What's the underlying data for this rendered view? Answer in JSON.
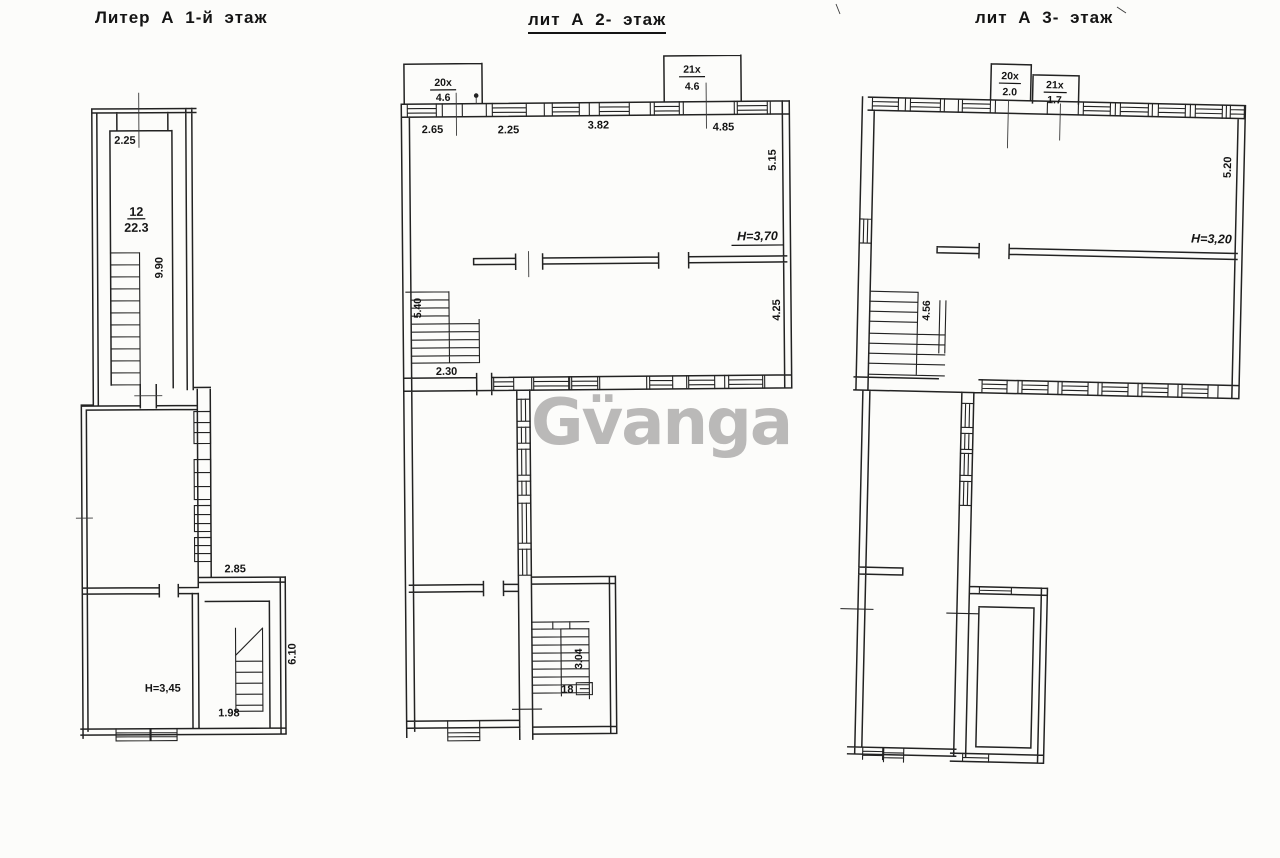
{
  "watermark": {
    "text": "Gv̈anga",
    "color": "#b2b0b0"
  },
  "plan1": {
    "title": "Литер А 1-й этаж",
    "dim_top": "2.25",
    "room_number": "12",
    "room_area": "22.3",
    "dim_vert": "9.90",
    "dim_annex_top": "2.85",
    "dim_annex_right": "6.10",
    "height_label": "H=3,45",
    "dim_stair": "1.98"
  },
  "plan2": {
    "title": "лит А 2- этаж",
    "balcony_left": {
      "num": "20x",
      "area": "4.6"
    },
    "balcony_right": {
      "num": "21x",
      "area": "4.6"
    },
    "dim_top_1": "2.65",
    "dim_top_2": "2.25",
    "dim_top_3": "3.82",
    "dim_top_4": "4.85",
    "dim_right_upper": "5.15",
    "height_label": "H=3,70",
    "dim_right_mid": "4.25",
    "dim_stair_vert": "5.40",
    "dim_stair_bottom": "2.30",
    "stair_dim_vert": "3.04",
    "stair_count": "18"
  },
  "plan3": {
    "title": "лит А 3- этаж",
    "balcony_left": {
      "num": "20x",
      "area": "2.0"
    },
    "balcony_right": {
      "num": "21x",
      "area": "1.7"
    },
    "dim_right_upper": "5.20",
    "height_label": "H=3,20",
    "dim_stair_vert": "4.56"
  }
}
